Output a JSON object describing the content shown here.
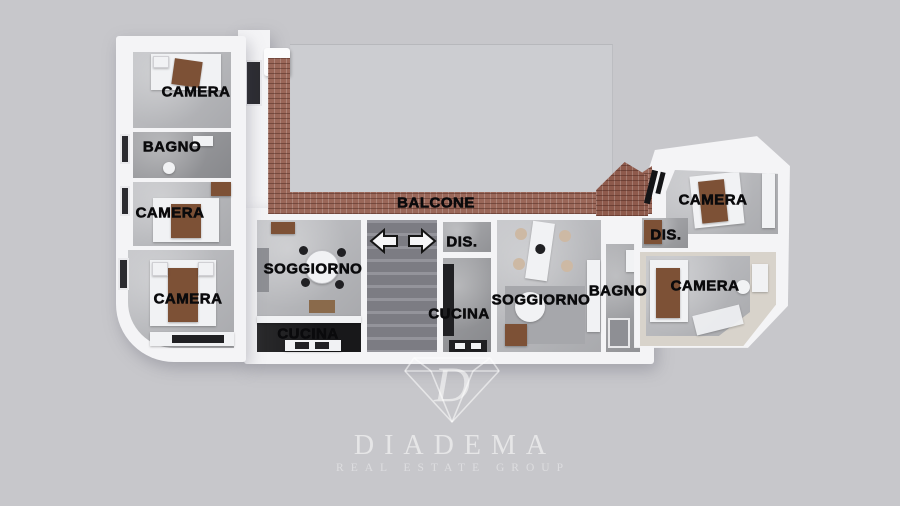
{
  "floorplan": {
    "labels": [
      {
        "id": "camera-top-left",
        "text": "CAMERA"
      },
      {
        "id": "bagno-left",
        "text": "BAGNO"
      },
      {
        "id": "camera-mid-left",
        "text": "CAMERA"
      },
      {
        "id": "camera-bottom-left",
        "text": "CAMERA"
      },
      {
        "id": "soggiorno-left",
        "text": "SOGGIORNO"
      },
      {
        "id": "cucina-left",
        "text": "CUCINA"
      },
      {
        "id": "balcone",
        "text": "BALCONE"
      },
      {
        "id": "dis-center",
        "text": "DIS."
      },
      {
        "id": "cucina-center",
        "text": "CUCINA"
      },
      {
        "id": "soggiorno-right",
        "text": "SOGGIORNO"
      },
      {
        "id": "bagno-right",
        "text": "BAGNO"
      },
      {
        "id": "camera-bottom-right",
        "text": "CAMERA"
      },
      {
        "id": "dis-right",
        "text": "DIS."
      },
      {
        "id": "camera-top-right",
        "text": "CAMERA"
      }
    ],
    "icons": {
      "stairs_direction_up": "arrow-right",
      "stairs_direction_down": "arrow-left"
    },
    "colors": {
      "background": "#c7c7cb",
      "wall": "#f4f4f6",
      "floor": "#bcbdc1",
      "kitchen_floor": "#18181a",
      "brick": "#9a6759",
      "stairs": "#86868d",
      "label": "#0a0a0c"
    }
  },
  "watermark": {
    "monogram": "D",
    "brand": "DIADEMA",
    "tagline": "REAL ESTATE GROUP",
    "icon": "diamond",
    "color": "#ffffff"
  }
}
